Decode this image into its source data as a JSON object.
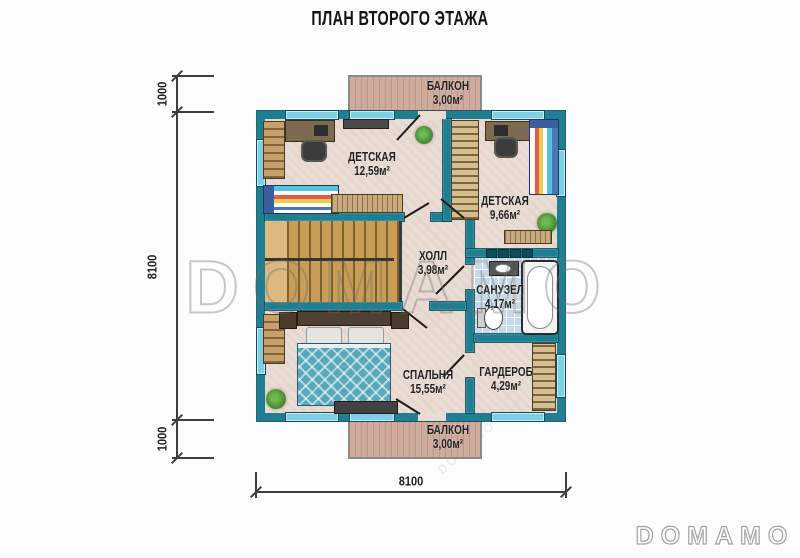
{
  "title": "ПЛАН ВТОРОГО ЭТАЖА",
  "watermark": {
    "text": "DOMAMO"
  },
  "logo": {
    "text": "DOMAMO"
  },
  "rooms": {
    "balcony_top": {
      "name": "БАЛКОН",
      "area": "3,00м²"
    },
    "kids1": {
      "name": "ДЕТСКАЯ",
      "area": "12,59м²"
    },
    "kids2": {
      "name": "ДЕТСКАЯ",
      "area": "9,66м²"
    },
    "hall": {
      "name": "ХОЛЛ",
      "area": "3,98м²"
    },
    "bathroom": {
      "name": "САНУЗЕЛ",
      "area": "4,17м²"
    },
    "bedroom": {
      "name": "СПАЛЬНЯ",
      "area": "15,55м²"
    },
    "wardrobe": {
      "name": "ГАРДЕРОБ",
      "area": "4,29м²"
    },
    "balcony_bottom": {
      "name": "БАЛКОН",
      "area": "3,00м²"
    }
  },
  "dimensions": {
    "left_top": "1000",
    "left_side": "8100",
    "left_bottom": "1000",
    "bottom_width": "8100"
  },
  "colors": {
    "wall": "#1e7f93",
    "win": "#7ecfe3",
    "floor": "#e9dcd4",
    "bath": "#c6d9e8",
    "stairs": "#c89d55",
    "balcony": "#cfab9e"
  }
}
